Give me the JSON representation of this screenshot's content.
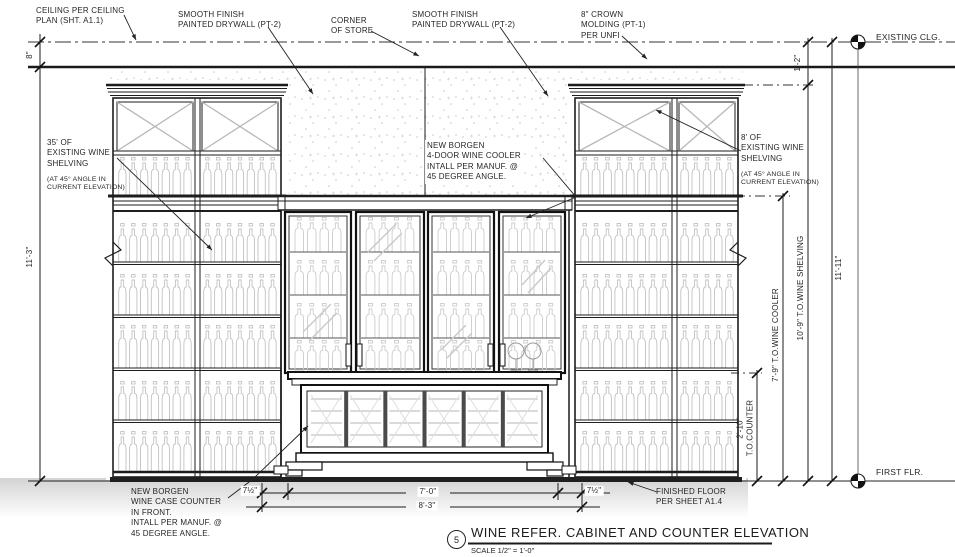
{
  "callouts": {
    "ceiling": "CEILING PER CEILING\nPLAN (SHT. A1.1)",
    "smooth_finish_left": "SMOOTH FINISH\nPAINTED DRYWALL (PT-2)",
    "corner_of_store": "CORNER\nOF STORE",
    "smooth_finish_right": "SMOOTH FINISH\nPAINTED DRYWALL (PT-2)",
    "crown_molding": "8\" CROWN\nMOLDING (PT-1)\nPER UNFI",
    "shelving_left": "35' OF\nEXISTING WINE\nSHELVING",
    "shelving_left_sub": "(AT 45° ANGLE IN\nCURRENT ELEVATION)",
    "wine_cooler": "NEW BORGEN\n4-DOOR WINE COOLER\nINTALL PER MANUF. @\n45 DEGREE ANGLE.",
    "shelving_right": "8' OF\nEXISTING WINE\nSHELVING",
    "shelving_right_sub": "(AT 45° ANGLE IN\nCURRENT ELEVATION)",
    "counter": "NEW BORGEN\nWINE CASE COUNTER\nIN FRONT.\nINTALL PER MANUF. @\n45 DEGREE ANGLE.",
    "finished_floor": "FINISHED FLOOR\nPER SHEET A1.4"
  },
  "levels": {
    "existing_ceiling": "EXISTING CLG.",
    "first_floor": "FIRST FLR."
  },
  "dimensions": {
    "ceiling_gap": "8\"",
    "wall_height": "11'-3\"",
    "clg_to_shelving": "1'-2\"",
    "counter_height": "2'-10\"\nT.O.COUNTER",
    "cooler_height": "7'-9\" T.O.WINE COOLER",
    "shelving_height": "10'-9\" T.O.WINE SHELVING",
    "overall_height": "11'-11\"",
    "cooler_width": "7'-0\"",
    "overall_width": "8'-3\"",
    "side_offset_left": "7½\"",
    "side_offset_right": "7½\""
  },
  "titleblock": {
    "detail_number": "5",
    "title": "WINE REFER. CABINET AND COUNTER ELEVATION",
    "scale": "SCALE 1/2\" = 1'-0\""
  }
}
